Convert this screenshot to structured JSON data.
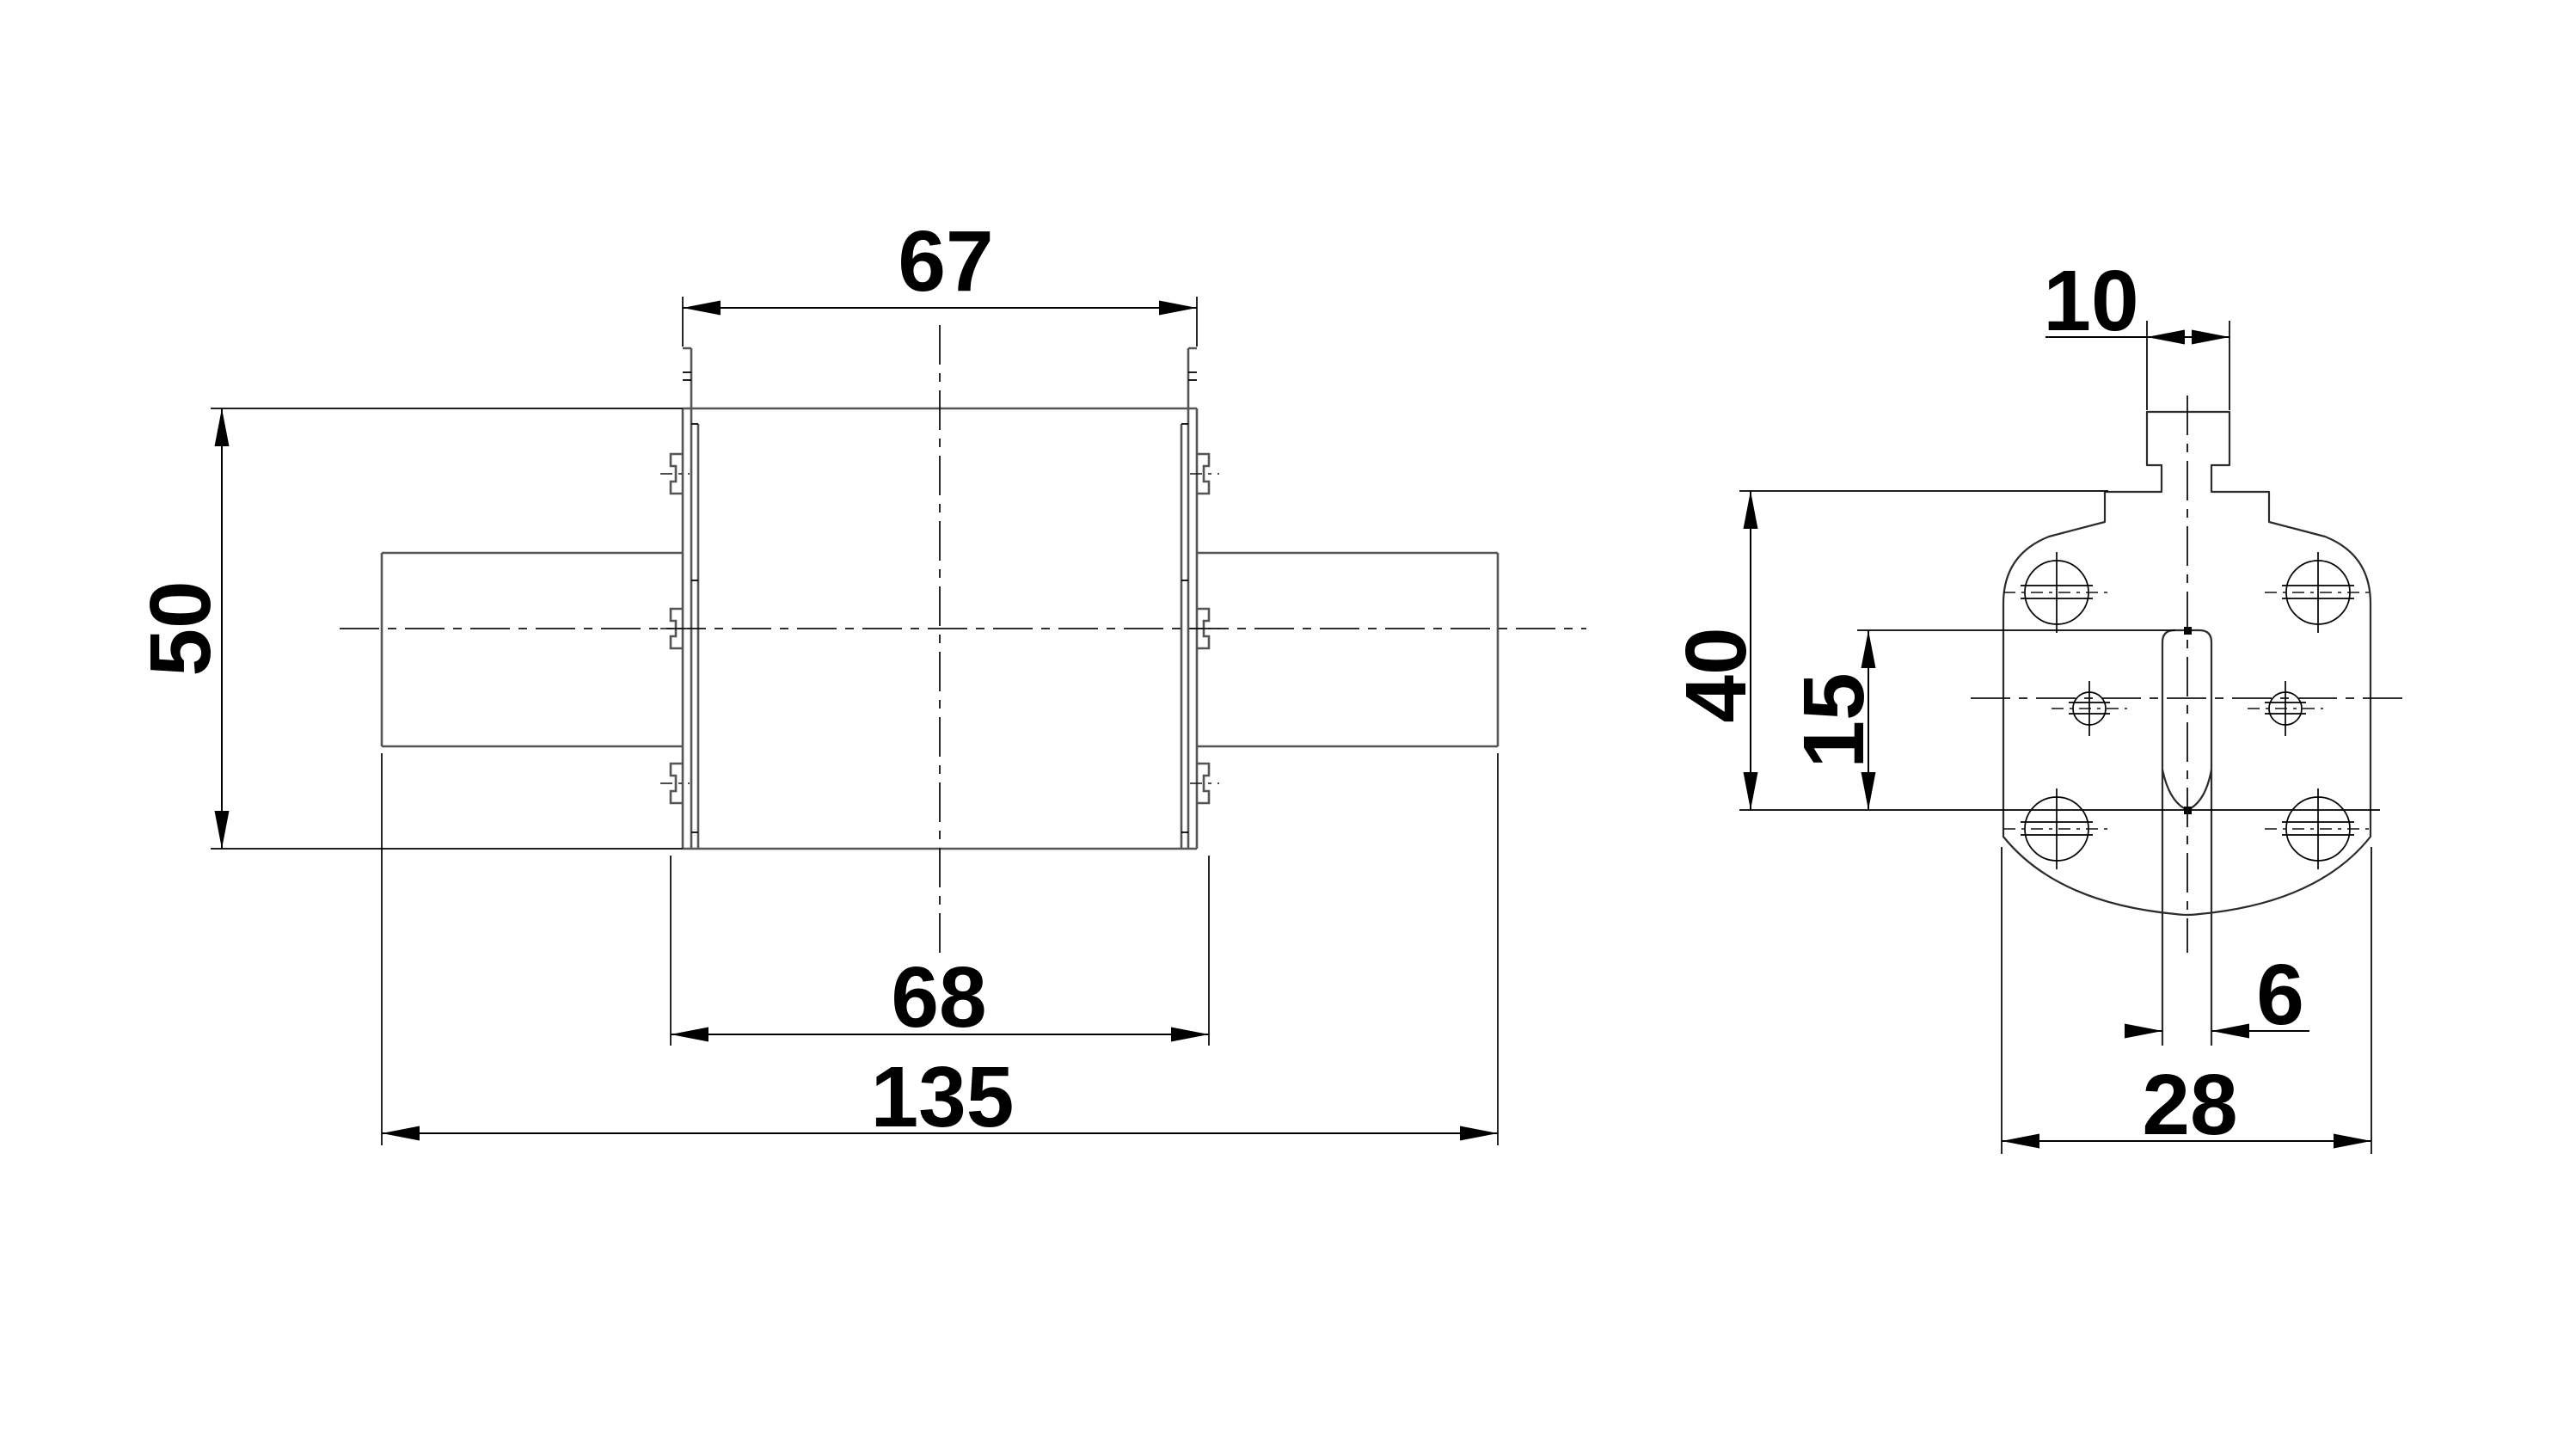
{
  "drawing": {
    "colors": {
      "line": "#000000",
      "geometry_gray": "#555555",
      "background": "#ffffff"
    },
    "views": {
      "front": {
        "dimensions": {
          "top_width": "67",
          "height": "50",
          "bottom_width": "68",
          "overall_length": "135"
        }
      },
      "side": {
        "dimensions": {
          "tab_width": "10",
          "height": "40",
          "slot_offset": "15",
          "blade_thickness": "6",
          "width": "28"
        }
      }
    }
  }
}
